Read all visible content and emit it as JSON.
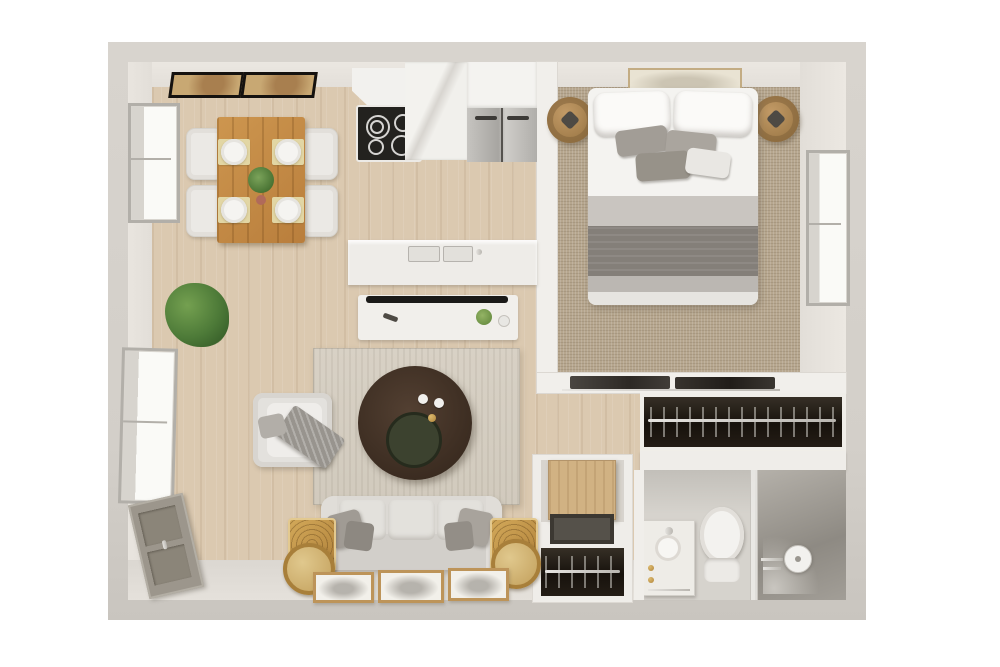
{
  "scene": {
    "type": "3d-rendered-apartment-floor-plan-top-view",
    "visible_text": [],
    "rooms": [
      {
        "name": "dining-area",
        "items": [
          "dining-table",
          "dining-chair-x4",
          "plate-with-placemat-x4",
          "table-centerpiece-plant",
          "wall-art-x2",
          "window"
        ]
      },
      {
        "name": "kitchen",
        "items": [
          "range-hood",
          "cooktop-stove",
          "marble-counter",
          "upper-cabinet",
          "refrigerator",
          "island-counter-with-double-sink",
          "media-console-with-tv"
        ]
      },
      {
        "name": "living-room",
        "items": [
          "area-rug",
          "armchair-with-throw",
          "round-coffee-table-with-tray",
          "three-seat-sofa",
          "gold-side-table-x2",
          "round-gold-mirror-x2",
          "leaning-floor-art-x3",
          "potted-plant",
          "window",
          "gray-storage-cabinet"
        ]
      },
      {
        "name": "bedroom",
        "items": [
          "double-bed",
          "head-pillow-x2",
          "accent-pillow-x4",
          "gray-blanket",
          "round-nightstand-x2",
          "wall-art",
          "carpet",
          "window",
          "sliding-closet-doors"
        ]
      },
      {
        "name": "wardrobe-closet",
        "items": [
          "clothes-rod-with-hangers"
        ]
      },
      {
        "name": "hallway-closet",
        "items": [
          "open-wood-door",
          "dark-shelf",
          "clothes-rod-with-hangers"
        ]
      },
      {
        "name": "bathroom",
        "items": [
          "marble-vanity-sink",
          "toilet",
          "walk-in-shower",
          "glass-partition",
          "shower-head",
          "shower-fixtures"
        ]
      }
    ]
  },
  "palette": {
    "background": "#ffffff",
    "outer_wall": "#d4d0ca",
    "inner_wall_face": "#e8e4de",
    "wood_floor": "#dbc9b0",
    "bedroom_carpet": "#b6a68e",
    "living_rug": "#d5cec2",
    "dining_table_wood": "#c38a49",
    "coffee_table_dark_wood": "#46342a",
    "sofa_fabric": "#dcd9d4",
    "bed_blanket_gray": "#847f79",
    "closet_interior": "#1f1913",
    "gold_accent": "#c69a52",
    "plant_green": "#55813f",
    "shower_wall_gray": "#a19d96",
    "stainless_steel": "#b4b2ae"
  }
}
